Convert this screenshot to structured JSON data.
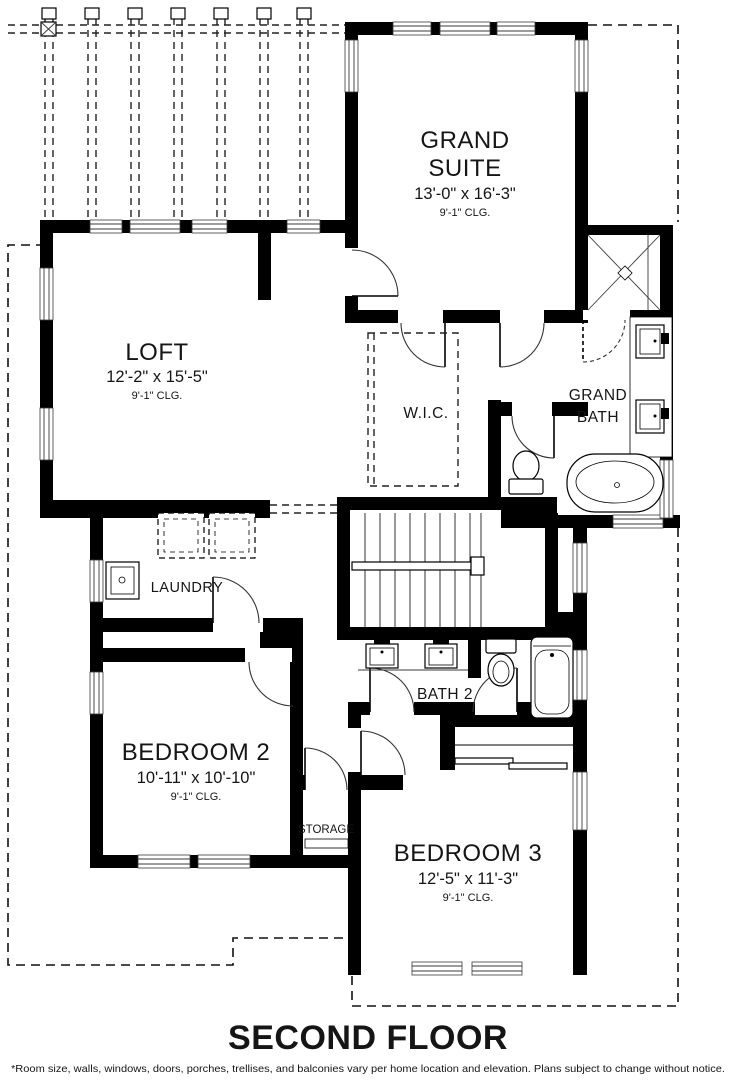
{
  "plan": {
    "title": "SECOND FLOOR",
    "disclaimer": "*Room size, walls, windows, doors, porches, trellises, and balconies vary per home location and elevation. Plans subject to change without notice.",
    "rooms": {
      "grand_suite": {
        "line1": "GRAND",
        "line2": "SUITE",
        "dims": "13'-0\" x 16'-3\"",
        "clg": "9'-1\" CLG."
      },
      "loft": {
        "name": "LOFT",
        "dims": "12'-2\" x 15'-5\"",
        "clg": "9'-1\" CLG."
      },
      "wic": {
        "name": "W.I.C."
      },
      "grand_bath": {
        "line1": "GRAND",
        "line2": "BATH"
      },
      "laundry": {
        "name": "LAUNDRY"
      },
      "bath2": {
        "name": "BATH 2"
      },
      "bedroom2": {
        "name": "BEDROOM 2",
        "dims": "10'-11\" x 10'-10\"",
        "clg": "9'-1\" CLG."
      },
      "storage": {
        "name": "STORAGE"
      },
      "bedroom3": {
        "name": "BEDROOM 3",
        "dims": "12'-5\" x 11'-3\"",
        "clg": "9'-1\" CLG."
      }
    }
  }
}
